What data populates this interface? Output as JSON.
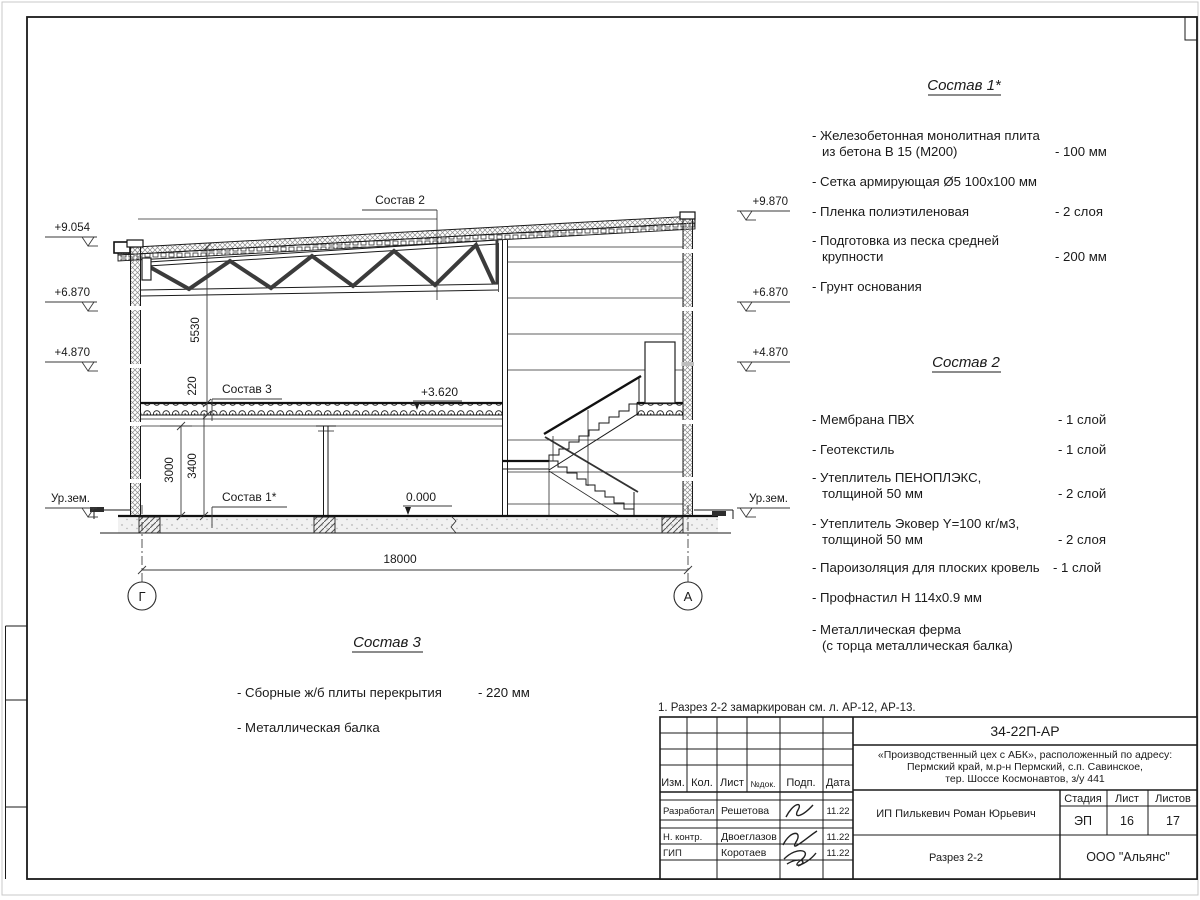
{
  "frame": {
    "note": "1. Разрез 2-2 замаркирован см. л. АР-12, АР-13."
  },
  "compositions": {
    "c1": {
      "title": "Состав 1*",
      "i1a": "- Железобетонная  монолитная плита",
      "i1b": "из бетона В 15 (М200)",
      "i1v": "- 100 мм",
      "i2a": "- Сетка армирующая Ø5 100х100 мм",
      "i3a": "- Пленка полиэтиленовая",
      "i3v": "-  2 слоя",
      "i4a": "- Подготовка из песка средней",
      "i4b": "крупности",
      "i4v": "- 200 мм",
      "i5a": "- Грунт основания"
    },
    "c2": {
      "title": "Состав 2",
      "i1a": "- Мембрана ПВХ",
      "i1v": "- 1 слой",
      "i2a": "- Геотекстиль",
      "i2v": "- 1 слой",
      "i3a": "- Утеплитель ПЕНОПЛЭКС,",
      "i3b": "толщиной 50 мм",
      "i3v": "- 2 слой",
      "i4a": "- Утеплитель Эковер Y=100 кг/м3,",
      "i4b": "толщиной 50 мм",
      "i4v": "- 2 слоя",
      "i5a": "- Пароизоляция для плоских кровель",
      "i5v": "- 1 слой",
      "i6a": "- Профнастил Н 114х0.9 мм",
      "i7a": "- Металлическая ферма",
      "i7b": "(с торца металлическая балка)"
    },
    "c3": {
      "title": "Состав 3",
      "i1a": "- Сборные ж/б  плиты перекрытия",
      "i1v": "- 220 мм",
      "i2a": "- Металлическая балка"
    }
  },
  "drawing": {
    "elev_left": [
      "+9.054",
      "+6.870",
      "+4.870",
      "Ур.зем."
    ],
    "elev_right": [
      "+9.870",
      "+6.870",
      "+4.870",
      "Ур.зем."
    ],
    "dims": {
      "d5530": "5530",
      "d220": "220",
      "d3000": "3000",
      "d3400": "3400",
      "d18000": "18000"
    },
    "marks": {
      "m3620": "+3.620",
      "m0": "0.000"
    },
    "labels": {
      "sostav1": "Состав 1*",
      "sostav2": "Состав 2",
      "sostav3": "Состав 3"
    },
    "axes": {
      "left": "Г",
      "right": "А"
    }
  },
  "titleblock": {
    "doc_number": "34-22П-АР",
    "project_line1": "«Производственный цех с АБК», расположенный по адресу:",
    "project_line2": "Пермский край, м.р-н Пермский, с.п. Савинское,",
    "project_line3": "тер. Шоссе Космонавтов, з/у 441",
    "headers": {
      "izm": "Изм.",
      "kol": "Кол.",
      "list": "Лист",
      "ndok": "№док.",
      "podp": "Подп.",
      "data": "Дата",
      "stadia": "Стадия",
      "list2": "Лист",
      "listov": "Листов"
    },
    "rows": {
      "r1_role": "Разработал",
      "r1_name": "Решетова",
      "r1_date": "11.22",
      "r2_role": "Н. контр.",
      "r2_name": "Двоеглазов",
      "r2_date": "11.22",
      "r3_role": "ГИП",
      "r3_name": "Коротаев",
      "r3_date": "11.22"
    },
    "client": "ИП Пилькевич Роман Юрьевич",
    "stage": "ЭП",
    "sheet": "16",
    "sheets": "17",
    "title": "Разрез 2-2",
    "company": "ООО \"Альянс\""
  }
}
